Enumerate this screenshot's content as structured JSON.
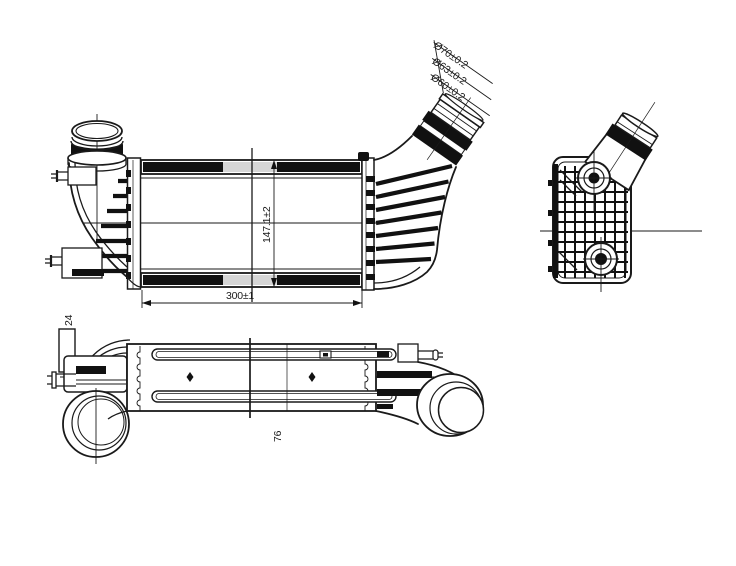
{
  "drawing": {
    "type": "technical-orthographic-views",
    "subject": "intercooler-line-drawing",
    "background": "#ffffff",
    "colors": {
      "line": "#1a1a1a",
      "solid_fill": "#111111",
      "hatch_gray": "#d6d6d6"
    },
    "views": {
      "front": {
        "label": "front-view"
      },
      "side": {
        "label": "side-view"
      },
      "bottom": {
        "label": "bottom-view"
      }
    },
    "dimensions": {
      "pipe_outer": "Ø70±0.2",
      "pipe_middle": "Ø63±0.2",
      "pipe_inner": "Ø60±0.2",
      "core_height": "147.1±2",
      "core_length": "300±1",
      "bracket_width": "24",
      "body_depth": "76"
    }
  }
}
